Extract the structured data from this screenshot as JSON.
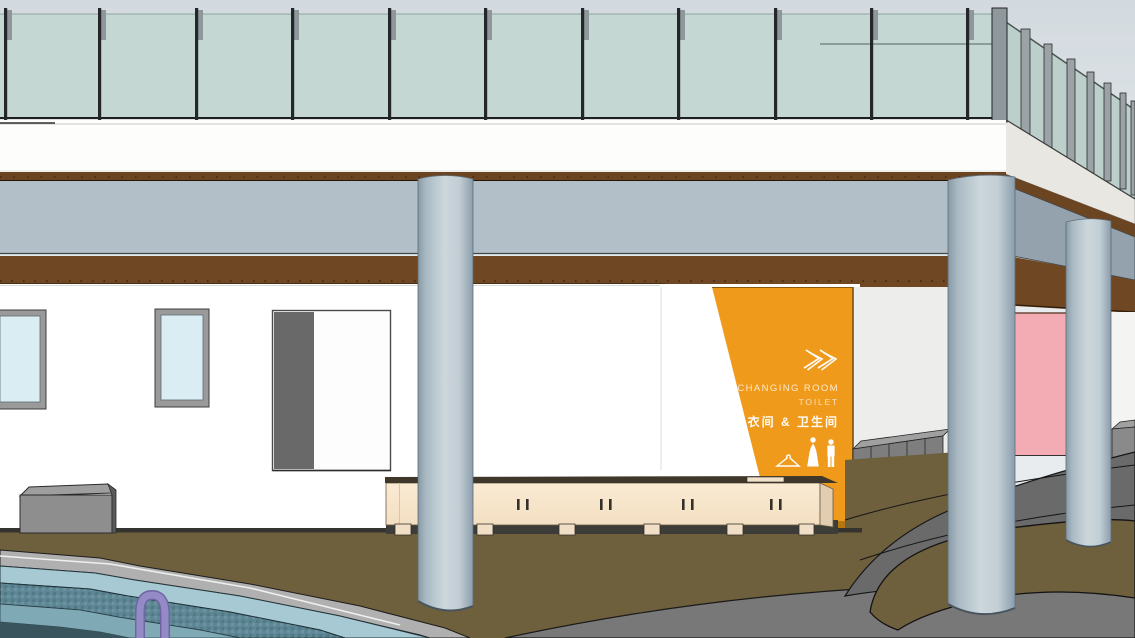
{
  "sign": {
    "line1": "CHANGING ROOM",
    "line2": "TOILET",
    "line3": "换衣间 & 卫生间",
    "panel_color": "#F09A1B",
    "panel_edge_color": "#B4770F",
    "text_color": "#FFFFFF",
    "icons": [
      "double-chevron-right-icon",
      "clothes-hanger-icon",
      "woman-figure-icon",
      "man-figure-icon"
    ]
  },
  "scene": {
    "elements": [
      "sky",
      "glass-railing",
      "railing-posts",
      "white-parapet",
      "wood-fascia-strip",
      "fascia-beam",
      "wood-soffit",
      "white-wall",
      "window",
      "window",
      "door-panel",
      "changing-room-sign",
      "back-wall",
      "pink-wall",
      "locker-row",
      "corner-boxes",
      "reception-bench",
      "bench-feet",
      "planter-box",
      "round-column",
      "round-column",
      "round-column",
      "terrace-floor",
      "paving-path",
      "pool-deck",
      "pool-coping",
      "pool-tile-wall",
      "pool-step",
      "pool-water",
      "pool-ladder"
    ],
    "colors": {
      "sky_top": "#d3dadf",
      "sky_bottom": "#e9edf0",
      "glass": "#c5d7d3",
      "glass_receding": "#bccfcb",
      "parapet_white": "#fdfdfc",
      "parapet_receding": "#e9e7e2",
      "wood_brown": "#6f4823",
      "beam_gray": "#b2bfc9",
      "beam_receding": "#94a2ad",
      "column_light": "#ccd7dc",
      "column_dark": "#8799a6",
      "wall_white": "#ffffff",
      "back_wall": "#ededeb",
      "pink_wall": "#f4acb4",
      "window_glass": "#d9edf3",
      "window_frame": "#9a9a9a",
      "door_gray": "#696969",
      "bench_cream": "#f9e8cf",
      "bench_top_dark": "#40372b",
      "locker_gray": "#7e7e7e",
      "ground_brown": "#6e5f3d",
      "paving_gray": "#6a6a6a",
      "paving_light": "#787878",
      "deck_gray": "#b0b0b0",
      "pool_coping": "#a6c9d4",
      "pool_tile": "#5d8795",
      "pool_step": "#7fa9b5",
      "pool_deep": "#3a545e",
      "ladder_purple": "#948bc6"
    }
  }
}
